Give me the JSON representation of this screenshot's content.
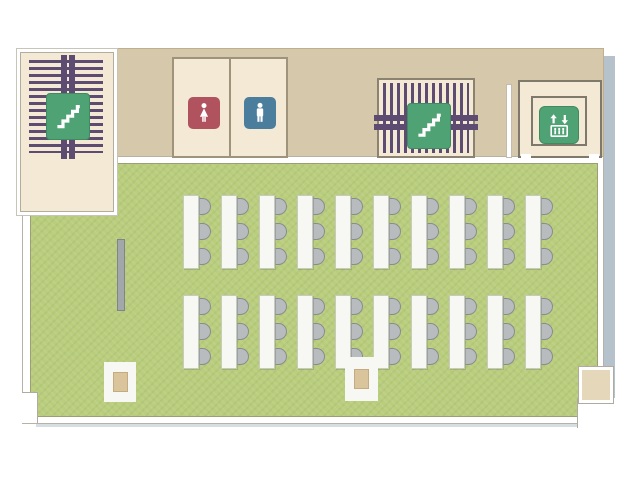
{
  "scene": {
    "kind": "cafeteria-floor-plan"
  },
  "colors": {
    "floor_green": "#b9cd7d",
    "wall_tan": "#d5c8ab",
    "room_cream": "#f3e9d5",
    "stripe_purple": "#5d4b72",
    "icon_green": "#4fa273",
    "female_red": "#b1525f",
    "male_blue": "#4b7e9d",
    "chair_gray": "#b8bcbf",
    "table_white": "#f7f8f4",
    "pillar_beige": "#d9c49c",
    "shadow_blue": "#b6c2cb"
  },
  "icons": {
    "stairs_left": "stairs-icon",
    "stairs_right": "stairs-icon",
    "female": "female-restroom-icon",
    "male": "male-restroom-icon",
    "elevator": "elevator-icon"
  },
  "seating": {
    "rows": 2,
    "tables_per_row": 10,
    "seats_per_table": 3,
    "row_tops": [
      194,
      294
    ],
    "start_x": 182,
    "pitch_x": 38,
    "chair_tops": [
      3,
      28,
      53
    ]
  },
  "furniture": {
    "pillars": 2,
    "partitions": 1
  }
}
